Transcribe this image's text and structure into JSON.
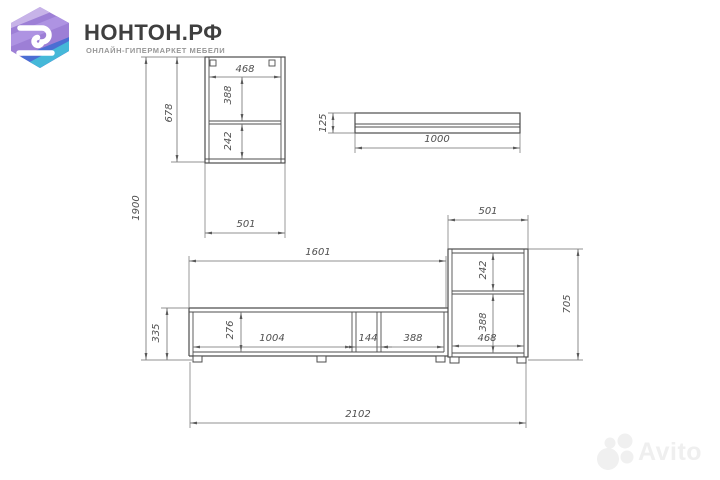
{
  "header": {
    "brand_title": "НОНТОН.РФ",
    "brand_subtitle": "ОНЛАЙН-ГИПЕРМАРКЕТ МЕБЕЛИ",
    "logo_colors": {
      "light": "#c7b3e8",
      "mid": "#9d7fd6",
      "band": "#ae93e2",
      "blue": "#4b6ed3",
      "teal": "#45b8d8"
    }
  },
  "drawing": {
    "kind": "furniture dimension drawing (wall unit / TV stand)",
    "units": "mm",
    "wall_cabinet": {
      "width": "501",
      "height": "678",
      "inner_width": "468",
      "upper_section": "388",
      "lower_section": "242"
    },
    "shelf": {
      "thickness": "125",
      "length": "1000"
    },
    "tv_stand": {
      "length": "1601",
      "height": "335",
      "inner_height": "276",
      "left_compartment": "1004",
      "middle_compartment": "144",
      "right_compartment": "388"
    },
    "side_cabinet": {
      "width": "501",
      "height": "705",
      "inner_width": "468",
      "upper_section": "242",
      "lower_section": "388"
    },
    "total_width": "2102",
    "total_height": "1900"
  },
  "watermark": {
    "text": "Avito"
  }
}
